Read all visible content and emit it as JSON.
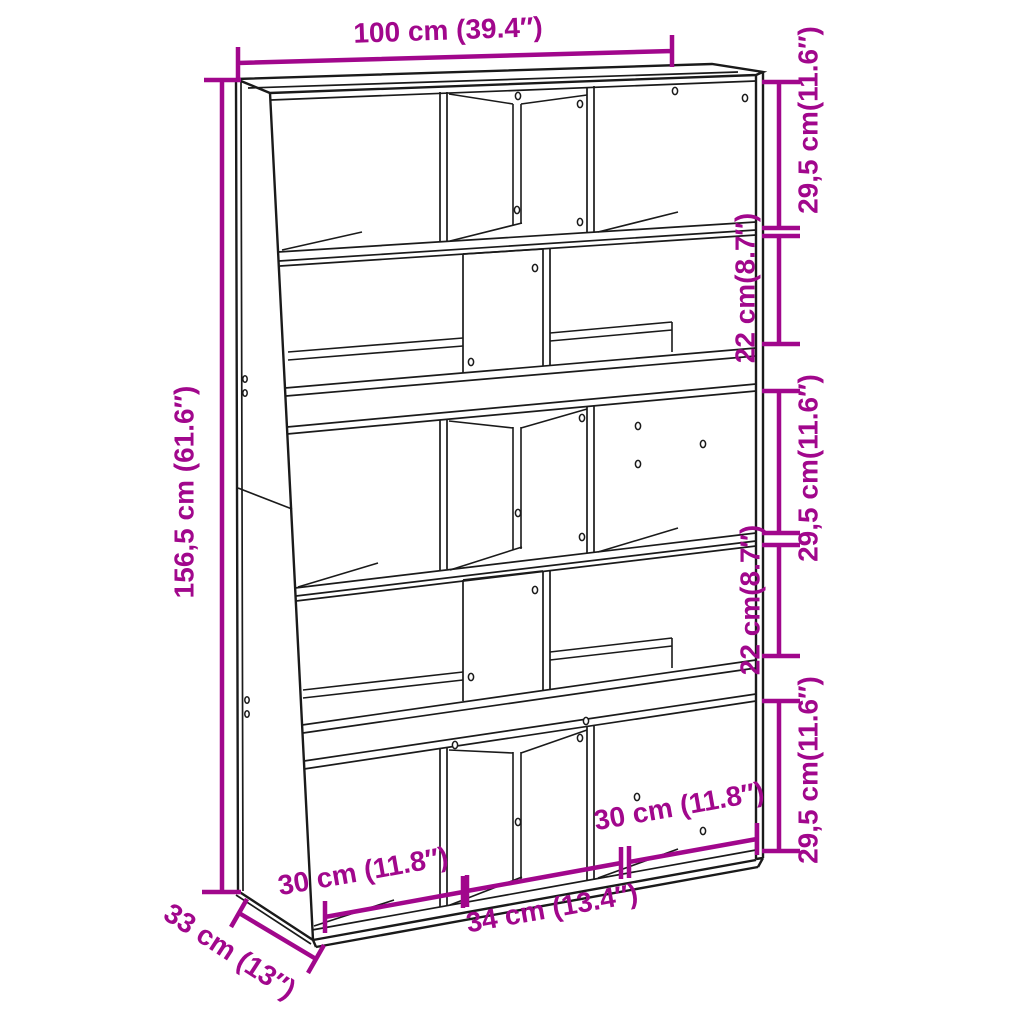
{
  "diagram": {
    "kind": "furniture-dimension-drawing",
    "accent_color": "#A1078C",
    "line_color": "#1A1A1A",
    "background_color": "#FFFFFF",
    "dimensions": {
      "width_top": "100 cm (39.4″)",
      "height_left": "156,5 cm (61.6″)",
      "depth": "33 cm (13″)",
      "right_side": [
        {
          "label": "29,5 cm(11.6″)"
        },
        {
          "label": "22 cm(8.7″)"
        },
        {
          "label": "29,5 cm(11.6″)"
        },
        {
          "label": "22 cm(8.7″)"
        },
        {
          "label": "29,5 cm(11.6″)"
        }
      ],
      "bottom": [
        {
          "label": "30 cm (11.8″)"
        },
        {
          "label": "34 cm (13.4″)"
        },
        {
          "label": "30 cm (11.8″)"
        }
      ]
    }
  }
}
